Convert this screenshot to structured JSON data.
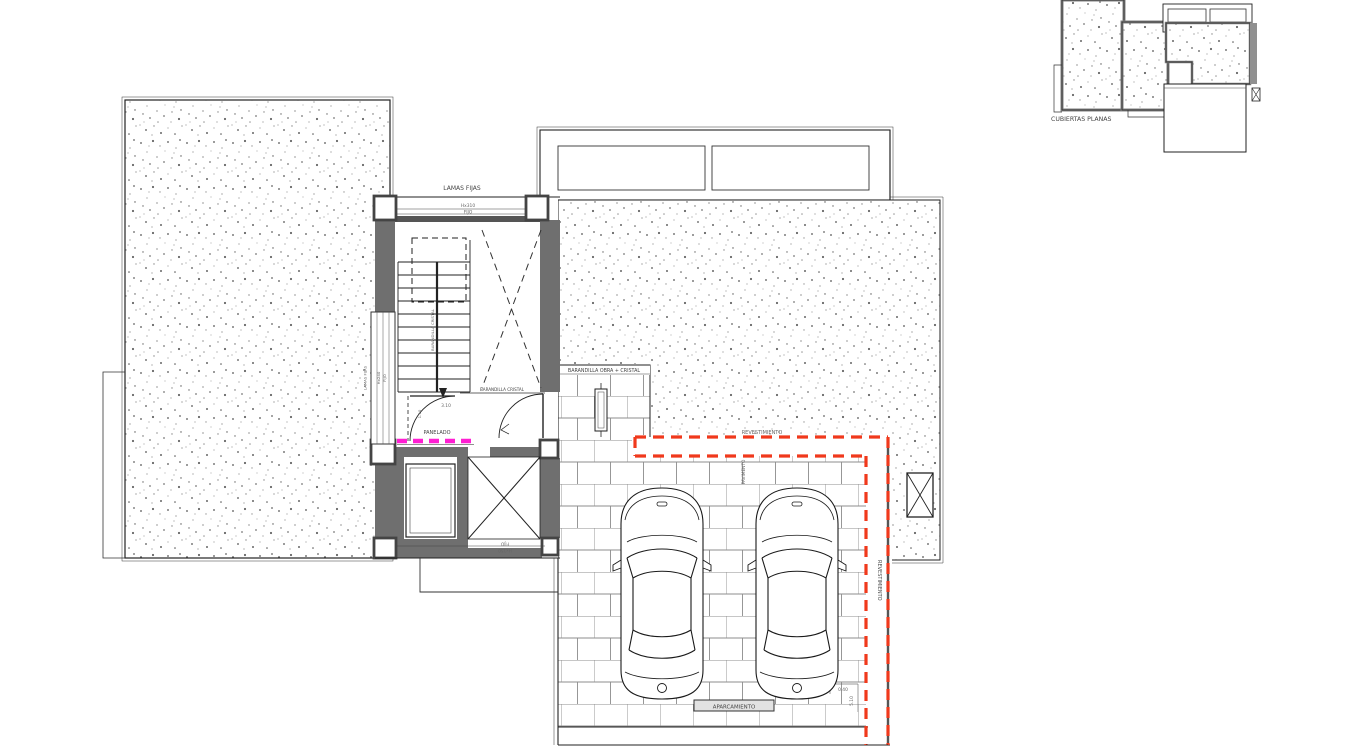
{
  "key_plan": {
    "label": "CUBIERTAS PLANAS"
  },
  "plan": {
    "labels": {
      "lamas_top": "LAMAS FIJAS",
      "hx310": "Hx310",
      "fijo_top": "FIJO",
      "lamas_left": "LAMAS FIJAS",
      "hx240": "Hx240",
      "fijo_left": "FIJO",
      "barandilla_stair": "BARANDILLA CRISTAL",
      "barandilla_landing": "BARANDILLA CRISTAL",
      "panelado": "PANELADO",
      "dim_310": "3.10",
      "dim_110": "1.10",
      "hx150": "Hx150",
      "fijo_lift": "FIJO",
      "barandilla_obra": "BARANDILLA OBRA + CRISTAL",
      "revestimiento_h": "REVESTIMIENTO",
      "revestimiento_v": "REVESTIMIENTO",
      "pavimento_v": "PAVIMENTO",
      "aparcamiento": "APARCAMIENTO",
      "dim_040": "0.40",
      "dim_510": "5.10"
    },
    "colors": {
      "red_dashed": "#f0391c",
      "magenta": "#ff1ed2",
      "wall": "#6f6f6f"
    }
  }
}
